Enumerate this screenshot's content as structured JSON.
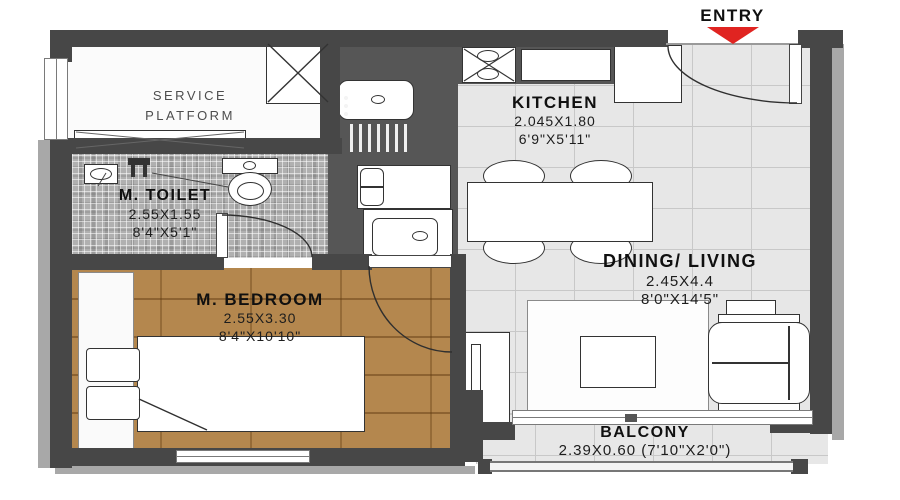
{
  "entry": {
    "label": "ENTRY"
  },
  "rooms": {
    "service_platform": {
      "line1": "SERVICE",
      "line2": "PLATFORM"
    },
    "kitchen": {
      "name": "KITCHEN",
      "dim_m": "2.045X1.80",
      "dim_ft": "6'9\"X5'11\""
    },
    "toilet": {
      "name": "M. TOILET",
      "dim_m": "2.55X1.55",
      "dim_ft": "8'4\"X5'1\""
    },
    "bedroom": {
      "name": "M. BEDROOM",
      "dim_m": "2.55X3.30",
      "dim_ft": "8'4\"X10'10\""
    },
    "dining_living": {
      "name": "DINING/ LIVING",
      "dim_m": "2.45X4.4",
      "dim_ft": "8'0\"X14'5\""
    },
    "balcony": {
      "name": "BALCONY",
      "dim": "2.39X0.60 (7'10\"X2'0\")"
    }
  },
  "colors": {
    "wall": "#474747",
    "entry_arrow_red": "#e02421",
    "wood_floor": "#b4874e",
    "tile_floor": "#e7e7e7",
    "mosaic_floor": "#b0b0b0"
  }
}
